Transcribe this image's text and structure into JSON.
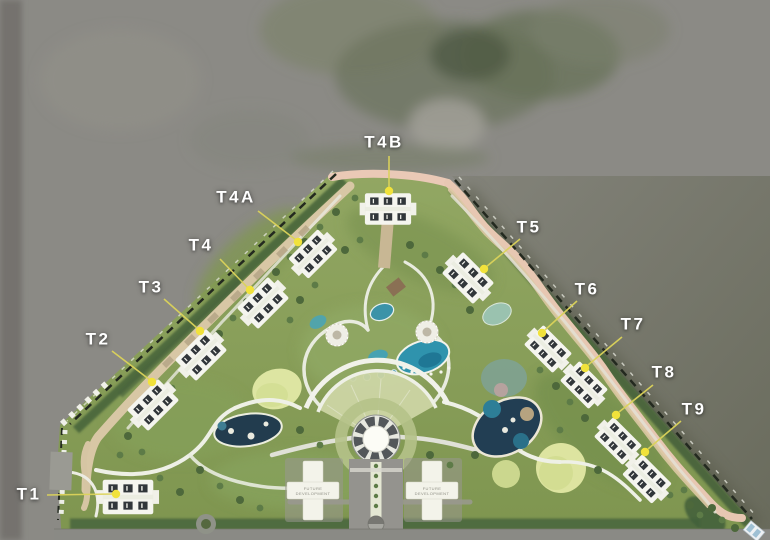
{
  "map": {
    "name": "Master plan aerial site map",
    "towers": [
      {
        "id": "t1",
        "label": "T1"
      },
      {
        "id": "t2",
        "label": "T2"
      },
      {
        "id": "t3",
        "label": "T3"
      },
      {
        "id": "t4",
        "label": "T4"
      },
      {
        "id": "t4a",
        "label": "T4A"
      },
      {
        "id": "t4b",
        "label": "T4B"
      },
      {
        "id": "t5",
        "label": "T5"
      },
      {
        "id": "t6",
        "label": "T6"
      },
      {
        "id": "t7",
        "label": "T7"
      },
      {
        "id": "t8",
        "label": "T8"
      },
      {
        "id": "t9",
        "label": "T9"
      }
    ],
    "future_pads": [
      {
        "line1": "FUTURE",
        "line2": "DEVELOPMENT"
      },
      {
        "line1": "FUTURE",
        "line2": "DEVELOPMENT"
      }
    ],
    "colors": {
      "label_text": "#ffffff",
      "leader_line": "#dcd35a",
      "marker_dot": "#f1e23b",
      "site_green": "#8ba05e",
      "surround_gray": "#8b8a85",
      "water_olive": "#6c6d5f",
      "pool_teal": "#2f93ad",
      "lagoon_navy": "#223e53",
      "road_tan": "#d8c7a5",
      "road_pink": "#eac9b6",
      "building_white": "#f5f5ef"
    }
  }
}
